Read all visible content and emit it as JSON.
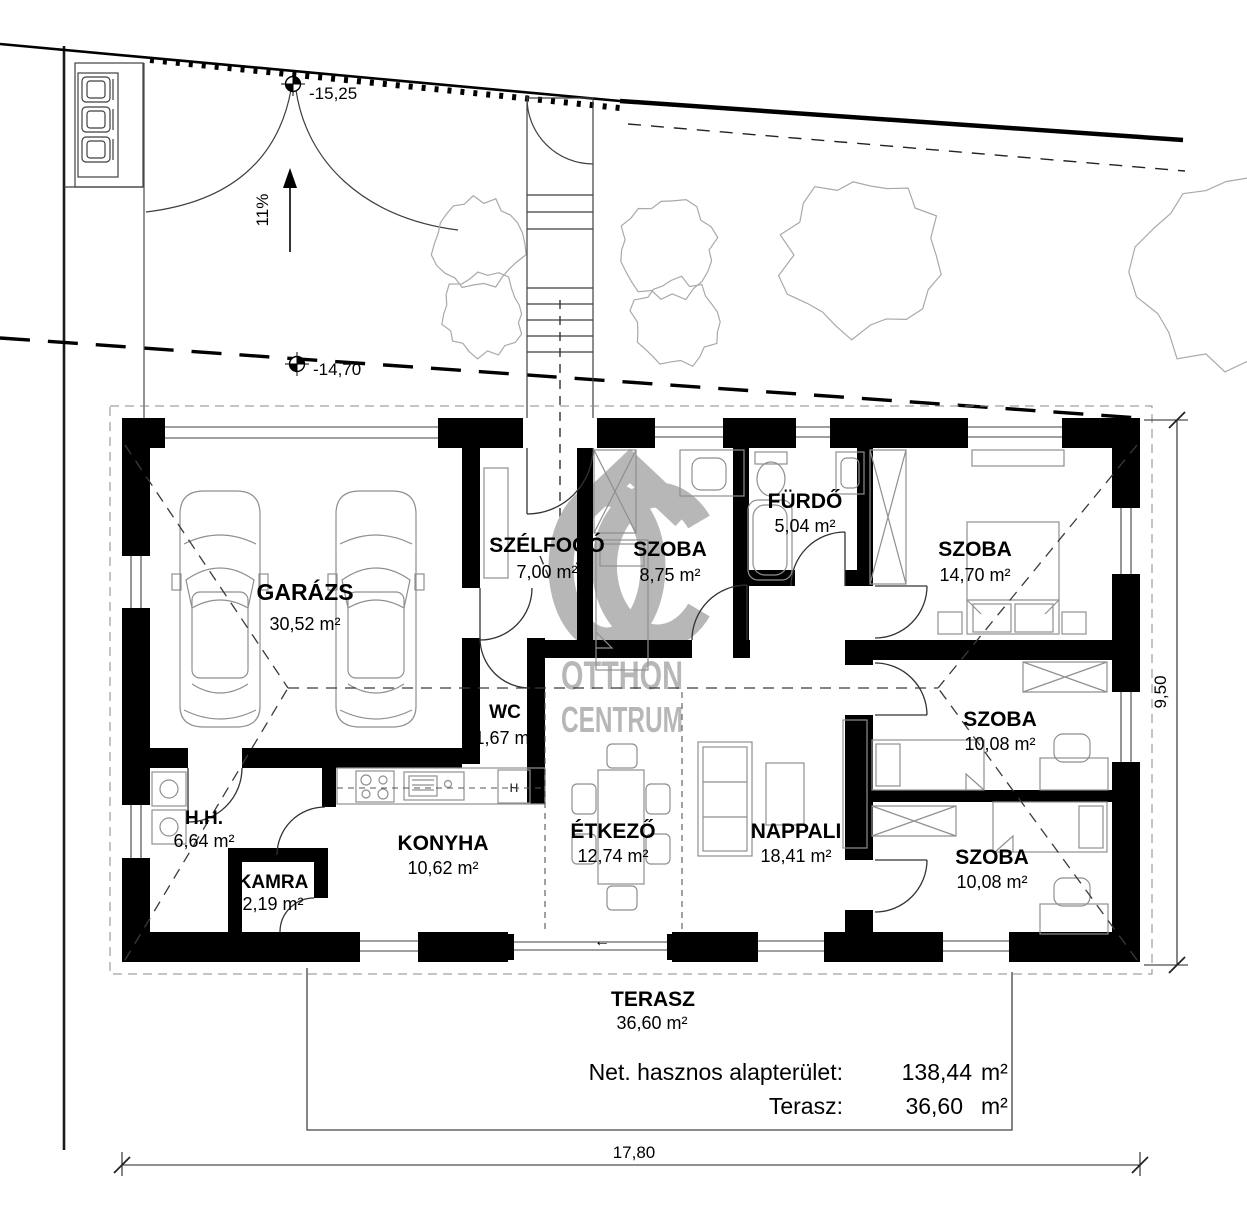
{
  "site": {
    "elevation_top": "-15,25",
    "elevation_mid": "-14,70",
    "slope_label": "11%"
  },
  "rooms": {
    "garazs": {
      "name": "GARÁZS",
      "area": "30,52 m²"
    },
    "szelfogo": {
      "name": "SZÉLFOGÓ",
      "area": "7,00 m²"
    },
    "wc": {
      "name": "WC",
      "area": "1,67 m²"
    },
    "szoba_eszaki": {
      "name": "SZOBA",
      "area": "8,75 m²"
    },
    "furdo": {
      "name": "FÜRDŐ",
      "area": "5,04 m²"
    },
    "szoba_keleti": {
      "name": "SZOBA",
      "area": "14,70 m²"
    },
    "szoba_kozep": {
      "name": "SZOBA",
      "area": "10,08 m²"
    },
    "szoba_deli": {
      "name": "SZOBA",
      "area": "10,08 m²"
    },
    "hh": {
      "name": "H.H.",
      "area": "6,64 m²"
    },
    "kamra": {
      "name": "KAMRA",
      "area": "2,19 m²"
    },
    "konyha": {
      "name": "KONYHA",
      "area": "10,62 m²"
    },
    "etkezo": {
      "name": "ÉTKEZŐ",
      "area": "12,74 m²"
    },
    "nappali": {
      "name": "NAPPALI",
      "area": "18,41 m²"
    }
  },
  "terrace": {
    "name": "TERASZ",
    "area": "36,60 m²"
  },
  "summary": {
    "row1": {
      "label": "Net. hasznos alapterület:",
      "value": "138,44",
      "unit": "m²"
    },
    "row2": {
      "label": "Terasz:",
      "value": "36,60",
      "unit": "m²"
    }
  },
  "dimensions": {
    "width": "17,80",
    "depth": "9,50"
  },
  "appliances": {
    "fridge_label": "H"
  },
  "markers": {
    "terrace_door_arrow": "←"
  },
  "watermark": {
    "line1": "OTTHON",
    "line2": "CENTRUM"
  },
  "colors": {
    "walls": "#000000",
    "thin_line": "#3f3f3f",
    "furniture_line": "#8f8f8f",
    "tree_line": "#a9a9a9",
    "watermark": "#b7b7b7",
    "background": "#ffffff"
  }
}
